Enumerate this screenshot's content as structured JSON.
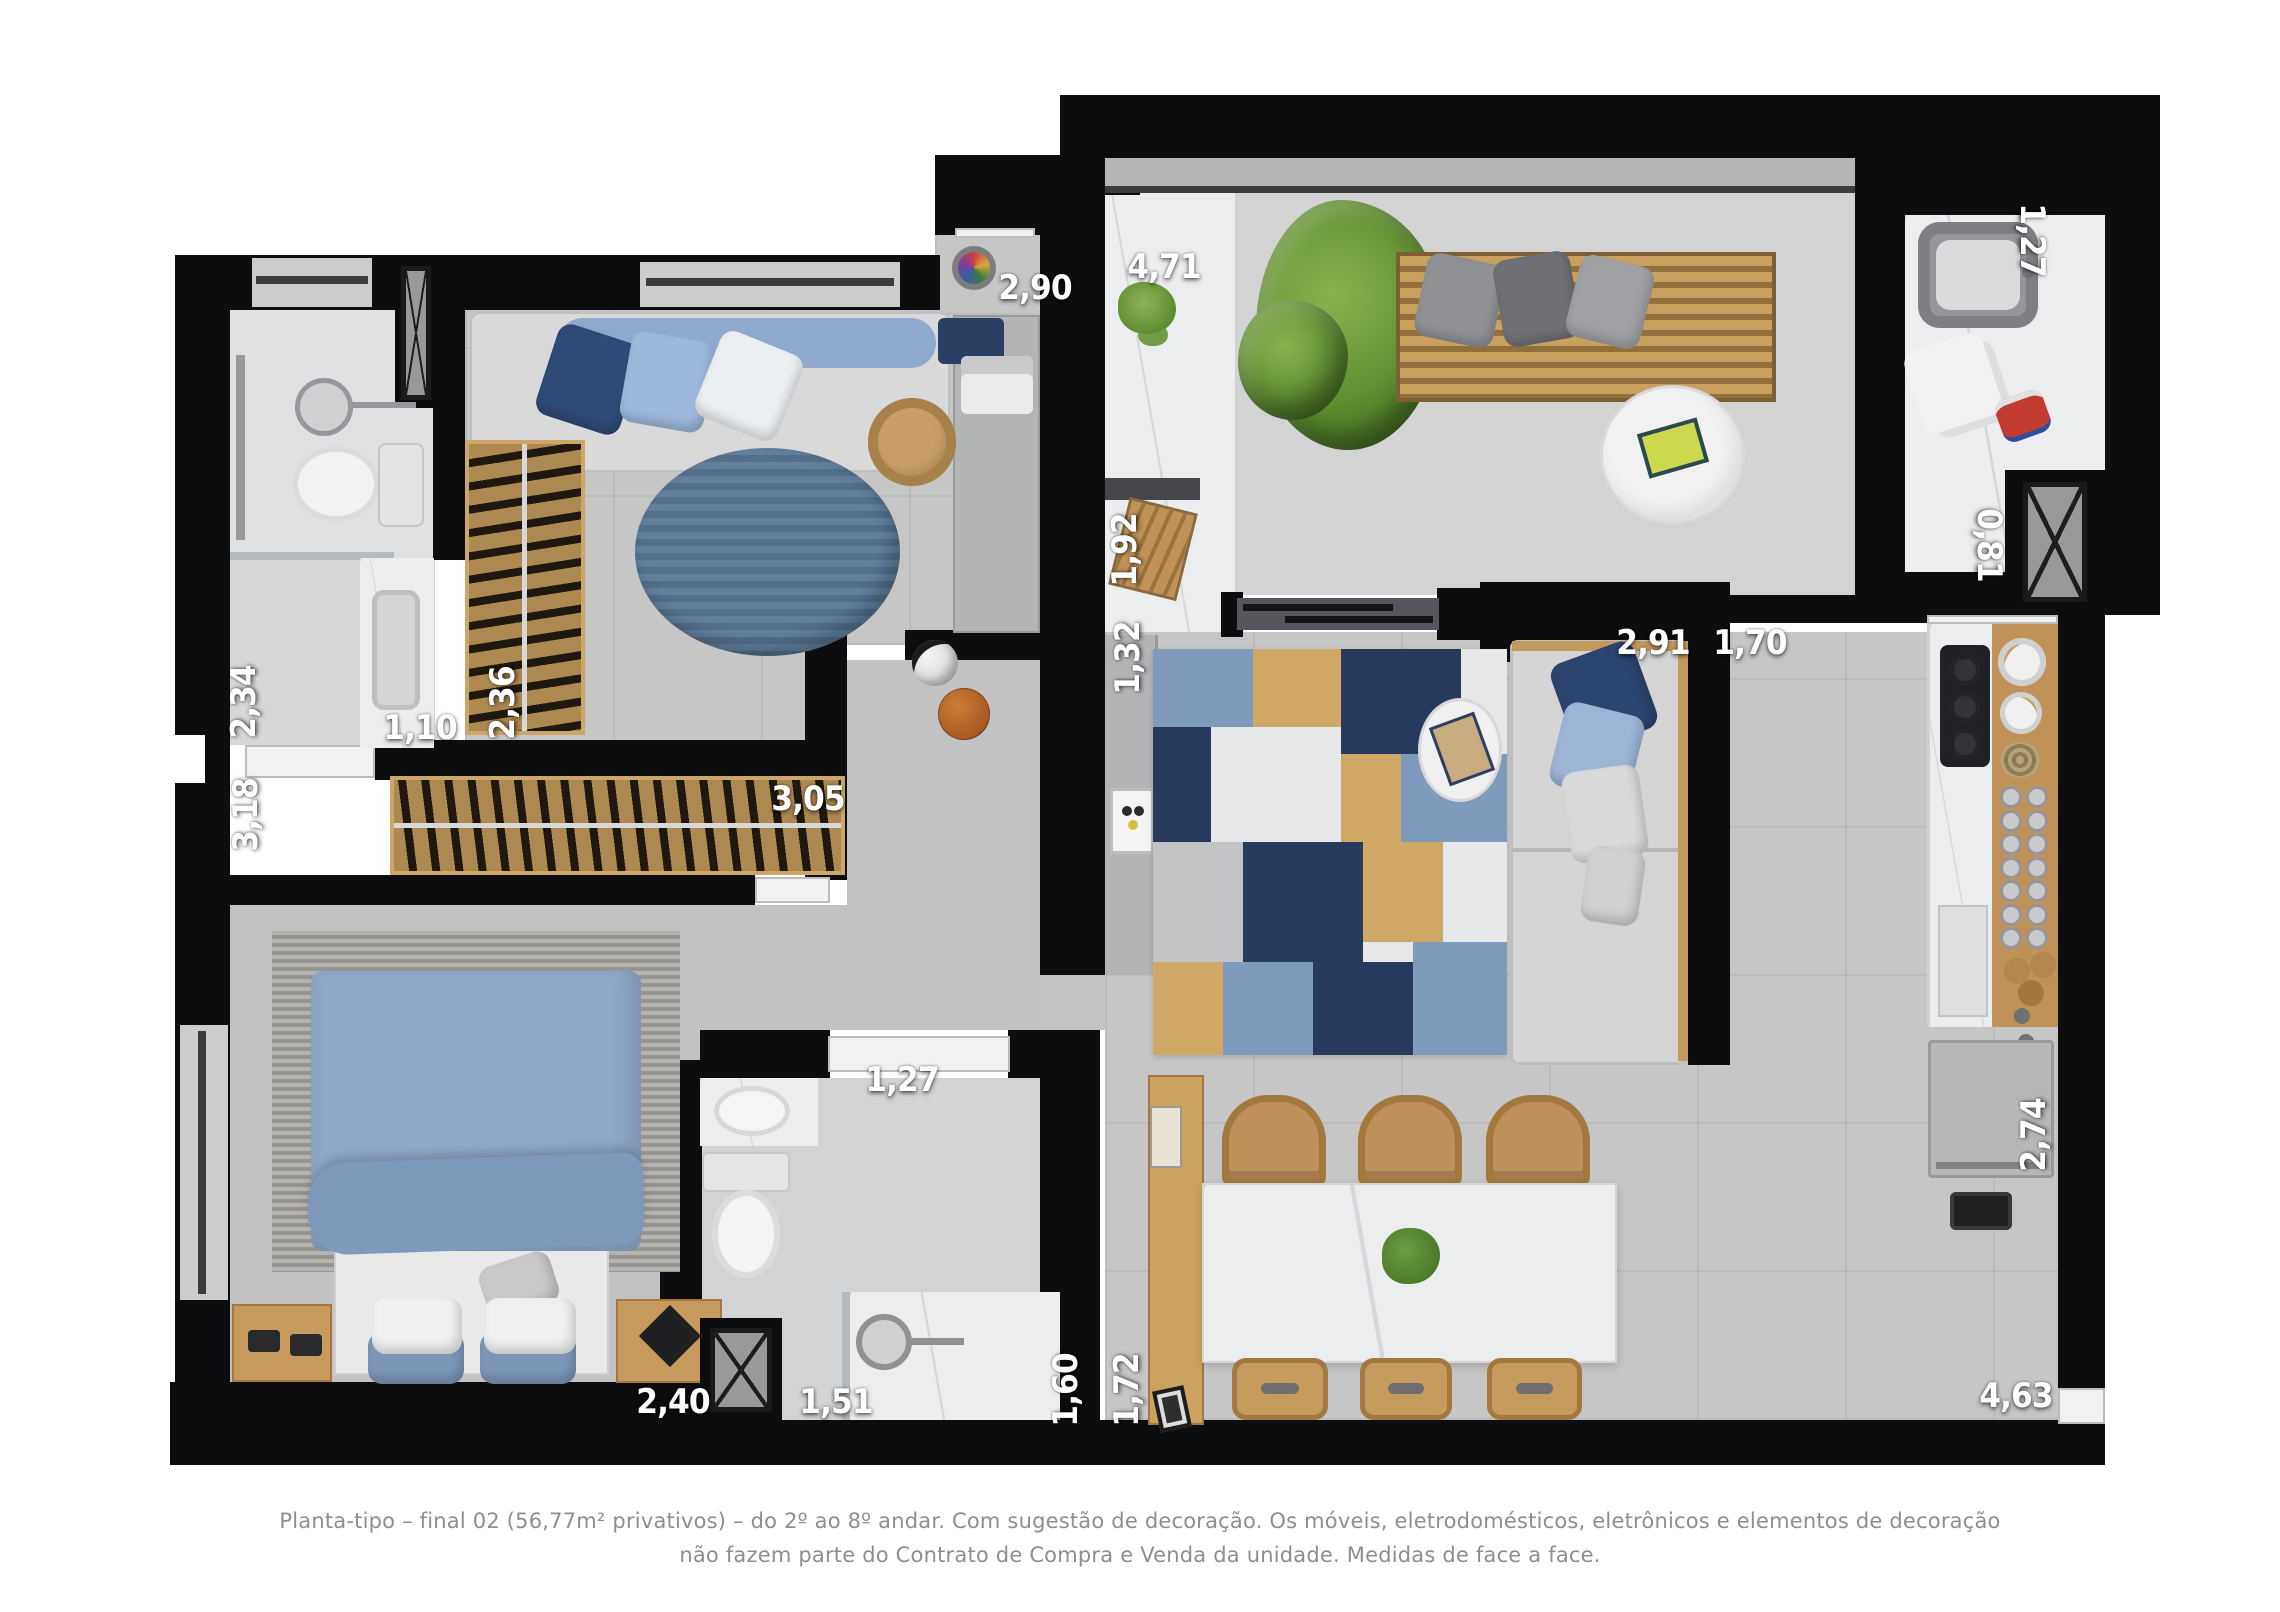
{
  "plan": {
    "type": "apartment-floor-plan-top-view",
    "colors": {
      "wall": "#0d0d0f",
      "floor_gray": "#c6c6c7",
      "marble": "#ecedee",
      "wood": "#c09258",
      "bed_blue": "#8fa7c8",
      "rug_navy": "#27395c",
      "rug_denim": "#7e9abc",
      "rug_tan": "#cfa866",
      "dim_label": "#ffffff",
      "caption_text": "#8e8e8e"
    }
  },
  "dimensions": [
    {
      "id": "terrace-width",
      "value": "4,71",
      "axis": "horizontal"
    },
    {
      "id": "ensuite-bath-width",
      "value": "1,27",
      "axis": "vertical"
    },
    {
      "id": "bedroom2-width",
      "value": "2,90",
      "axis": "horizontal"
    },
    {
      "id": "terrace-niche-depth",
      "value": "1,92",
      "axis": "vertical"
    },
    {
      "id": "shaft-width",
      "value": "0,81",
      "axis": "vertical"
    },
    {
      "id": "bathroom1-depth",
      "value": "2,34",
      "axis": "vertical"
    },
    {
      "id": "bathroom1-door-width",
      "value": "1,10",
      "axis": "horizontal"
    },
    {
      "id": "bedroom2-wardrobe-width",
      "value": "2,36",
      "axis": "vertical"
    },
    {
      "id": "bedroom1-depth",
      "value": "3,18",
      "axis": "vertical"
    },
    {
      "id": "bedroom1-wardrobe-width",
      "value": "3,05",
      "axis": "horizontal"
    },
    {
      "id": "tv-niche-width",
      "value": "1,32",
      "axis": "vertical"
    },
    {
      "id": "living-room-width",
      "value": "2,91",
      "axis": "horizontal"
    },
    {
      "id": "hall-passage-width",
      "value": "1,70",
      "axis": "horizontal"
    },
    {
      "id": "bathroom2-door-width",
      "value": "1,27",
      "axis": "horizontal"
    },
    {
      "id": "bed-width",
      "value": "2,40",
      "axis": "horizontal"
    },
    {
      "id": "bathroom2-width",
      "value": "1,51",
      "axis": "horizontal"
    },
    {
      "id": "shower-width",
      "value": "1,60",
      "axis": "vertical"
    },
    {
      "id": "sideboard-width",
      "value": "1,72",
      "axis": "vertical"
    },
    {
      "id": "kitchen-counter-depth",
      "value": "2,74",
      "axis": "vertical"
    },
    {
      "id": "kitchen-dining-width",
      "value": "4,63",
      "axis": "horizontal"
    }
  ],
  "caption": {
    "line1": "Planta-tipo – final 02 (56,77m² privativos) – do 2º ao 8º andar. Com sugestão de decoração. Os móveis, eletrodomésticos, eletrônicos e elementos de decoração",
    "line2": "não fazem parte do Contrato de Compra e Venda da unidade. Medidas de face a face."
  }
}
